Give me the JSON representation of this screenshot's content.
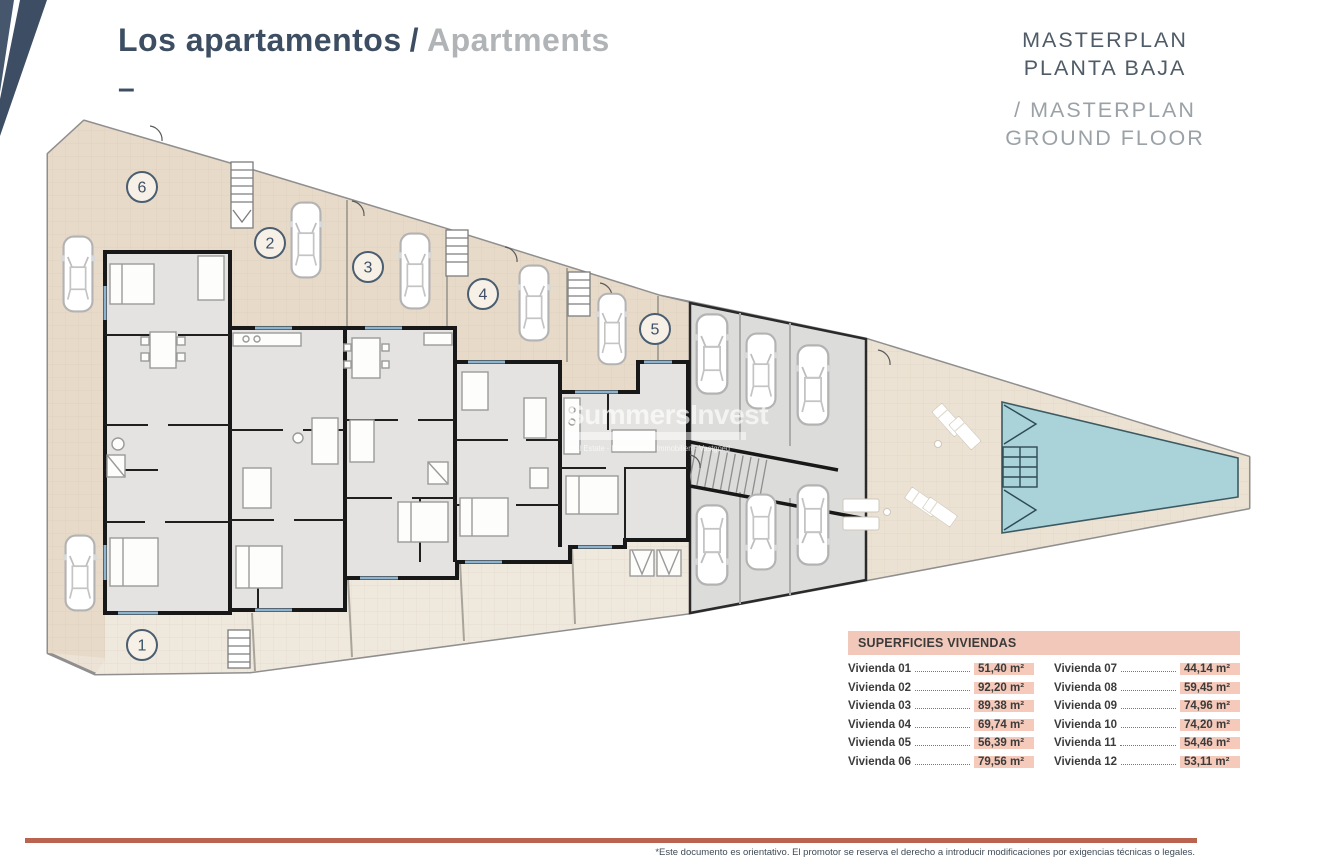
{
  "header": {
    "title_es": "Los apartamentos",
    "title_sep": "/",
    "title_en": "Apartments",
    "dash": "–"
  },
  "masterplan": {
    "line1_es": "MASTERPLAN",
    "line2_es": "PLANTA BAJA",
    "line1_en": "/ MASTERPLAN",
    "line2_en": "GROUND FLOOR"
  },
  "plan": {
    "units": [
      {
        "number": "1"
      },
      {
        "number": "2"
      },
      {
        "number": "3"
      },
      {
        "number": "4"
      },
      {
        "number": "5"
      },
      {
        "number": "6"
      }
    ],
    "watermark": {
      "brand": "SummersInvest",
      "tagline": "Real Estate - Inmobiliaria - Immobilien - Vastgoed"
    }
  },
  "areas_table": {
    "header": "SUPERFICIES VIVIENDAS",
    "columns": [
      {
        "rows": [
          {
            "label": "Vivienda 01",
            "value": "51,40 m²"
          },
          {
            "label": "Vivienda 02",
            "value": "92,20 m²"
          },
          {
            "label": "Vivienda 03",
            "value": "89,38 m²"
          },
          {
            "label": "Vivienda 04",
            "value": "69,74 m²"
          },
          {
            "label": "Vivienda 05",
            "value": "56,39 m²"
          },
          {
            "label": "Vivienda 06",
            "value": "79,56 m²"
          }
        ]
      },
      {
        "rows": [
          {
            "label": "Vivienda 07",
            "value": "44,14 m²"
          },
          {
            "label": "Vivienda 08",
            "value": "59,45 m²"
          },
          {
            "label": "Vivienda 09",
            "value": "74,96 m²"
          },
          {
            "label": "Vivienda 10",
            "value": "74,20 m²"
          },
          {
            "label": "Vivienda 11",
            "value": "54,46 m²"
          },
          {
            "label": "Vivienda 12",
            "value": "53,11 m²"
          }
        ]
      }
    ]
  },
  "footer": {
    "disclaimer": "*Este documento es orientativo. El promotor se reserva el derecho a introducir modificaciones por exigencias técnicas o legales."
  },
  "colors": {
    "navy": "#3d4e63",
    "title_light_gray": "#b1b4b6",
    "masterplan_gray": "#4f5b66",
    "masterplan_light": "#9ba2a7",
    "table_salmon": "#f2c8ba",
    "value_highlight": "#f5cabb",
    "footer_rule": "#b96350",
    "pool_water": "#a9d3d9",
    "plot_beige": "#ece3d6",
    "wall_black": "#181818"
  }
}
